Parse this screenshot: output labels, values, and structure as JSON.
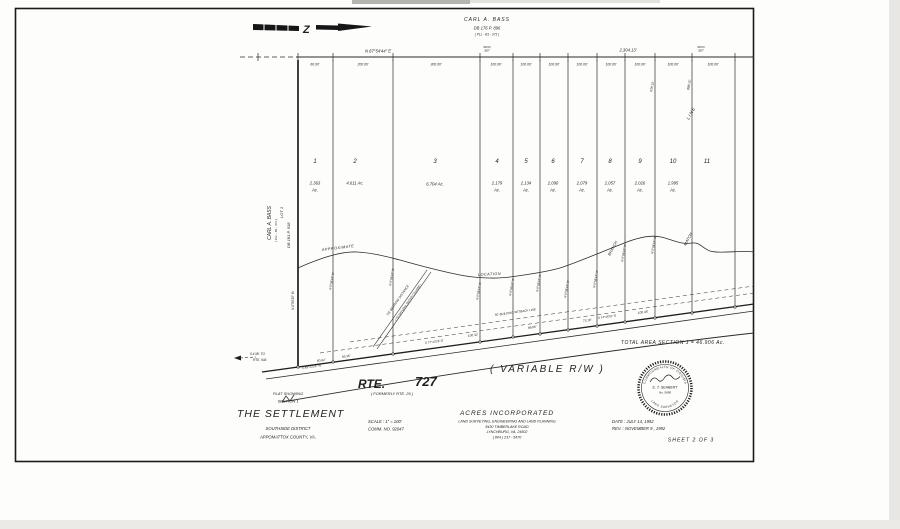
{
  "owner_top": {
    "l1": "CARL   A.   BASS",
    "l2": "DB 176         P. 896",
    "l3": "( PLL - B1 - 371 )"
  },
  "compass": {
    "glyph": "Z"
  },
  "dim": {
    "bearing": "N 87°54'44\" E",
    "total": "2,304.13'",
    "iron": "IRON",
    "set": "SET",
    "segments": [
      "60.00'",
      "200.00'",
      "300.00'",
      "100.00'",
      "100.00'",
      "100.00'",
      "100.00'",
      "100.00'",
      "100.00'",
      "100.00'",
      "100.00'"
    ]
  },
  "lots": [
    {
      "n": "1",
      "a": "2.363",
      "u": "Ac."
    },
    {
      "n": "2",
      "a": "4.611 Ac.",
      "u": ""
    },
    {
      "n": "3",
      "a": "6.704 Ac.",
      "u": ""
    },
    {
      "n": "4",
      "a": "2.179",
      "u": "Ac."
    },
    {
      "n": "5",
      "a": "2.134",
      "u": "Ac."
    },
    {
      "n": "6",
      "a": "2.090",
      "u": "Ac."
    },
    {
      "n": "7",
      "a": "2.079",
      "u": "Ac."
    },
    {
      "n": "8",
      "a": "2.057",
      "u": "Ac."
    },
    {
      "n": "9",
      "a": "2.026",
      "u": "Ac."
    },
    {
      "n": "10",
      "a": "1.995",
      "u": "Ac."
    },
    {
      "n": "11",
      "a": "",
      "u": ""
    }
  ],
  "owner_left": {
    "lot": "LOT    1",
    "name": "CARL   A.   BASS",
    "ref": "( PLL - B1 - 371 )",
    "db": "DB  181     P. 518"
  },
  "lines": {
    "bearing": "N 0°58'15\" W",
    "len10": "678.15'",
    "len11": "888.15'",
    "match": "MATCH",
    "line": "LINE"
  },
  "branch": {
    "l1": "APPROXIMATE",
    "l2": "LOCATION",
    "l3": "BRANCH"
  },
  "easement": {
    "l1": "TIE BEARING DISTANCE",
    "l2": "( TO NATURAL WATER COURSE )"
  },
  "road": {
    "rte": "RTE.",
    "num": "727",
    "formerly": "( FORMERLY  RTE. 26 )",
    "variable": "( VARIABLE      R/W )",
    "mi1": "0.4 MI. TO",
    "mi2": "RTE. 644",
    "setback": "50'  BUILDING  SETBACK  LINE",
    "b1": "S 77°43'26\" E",
    "b2": "S 74°45'51\" E",
    "b3": "S 89°43'26\" W",
    "d1": "100.32'",
    "d2": "99.85'",
    "d3": "73.18'",
    "d4": "100.45'",
    "d5": "93.35'",
    "d6": "60.62'"
  },
  "total_area": "TOTAL  AREA  SECTION  1  =  46.906  Ac.",
  "titleblock": {
    "plat": "PLAT  SHOWING",
    "section": "SECTION    1",
    "name": "THE   SETTLEMENT",
    "district": "SOUTHSIDE  DISTRICT",
    "county": "APPOMATTOX  COUNTY,  VA.",
    "scale": "SCALE : 1\" =  100'",
    "comm": "COMM. NO.  92047"
  },
  "firm": {
    "name": "ACRES   INCORPORATED",
    "l1": "LAND SURVEYING, ENGINEERING AND LAND PLANNING",
    "l2": "8430 TIMBERLAKE ROAD",
    "l3": "LYNCHBURG, VA.   24502",
    "l4": "( 804 ) 237 - 5470"
  },
  "dates": {
    "date": "DATE :  JULY 14, 1992",
    "rev": "REV. :  NOVEMBER  9 , 1992"
  },
  "sheet": "SHEET    2    OF    3",
  "seal": {
    "top": "COMMONWEALTH OF VIRGINIA",
    "name": "E. T. SEABERT",
    "no": "No. 5695",
    "bottom": "LAND SURVEYOR"
  }
}
